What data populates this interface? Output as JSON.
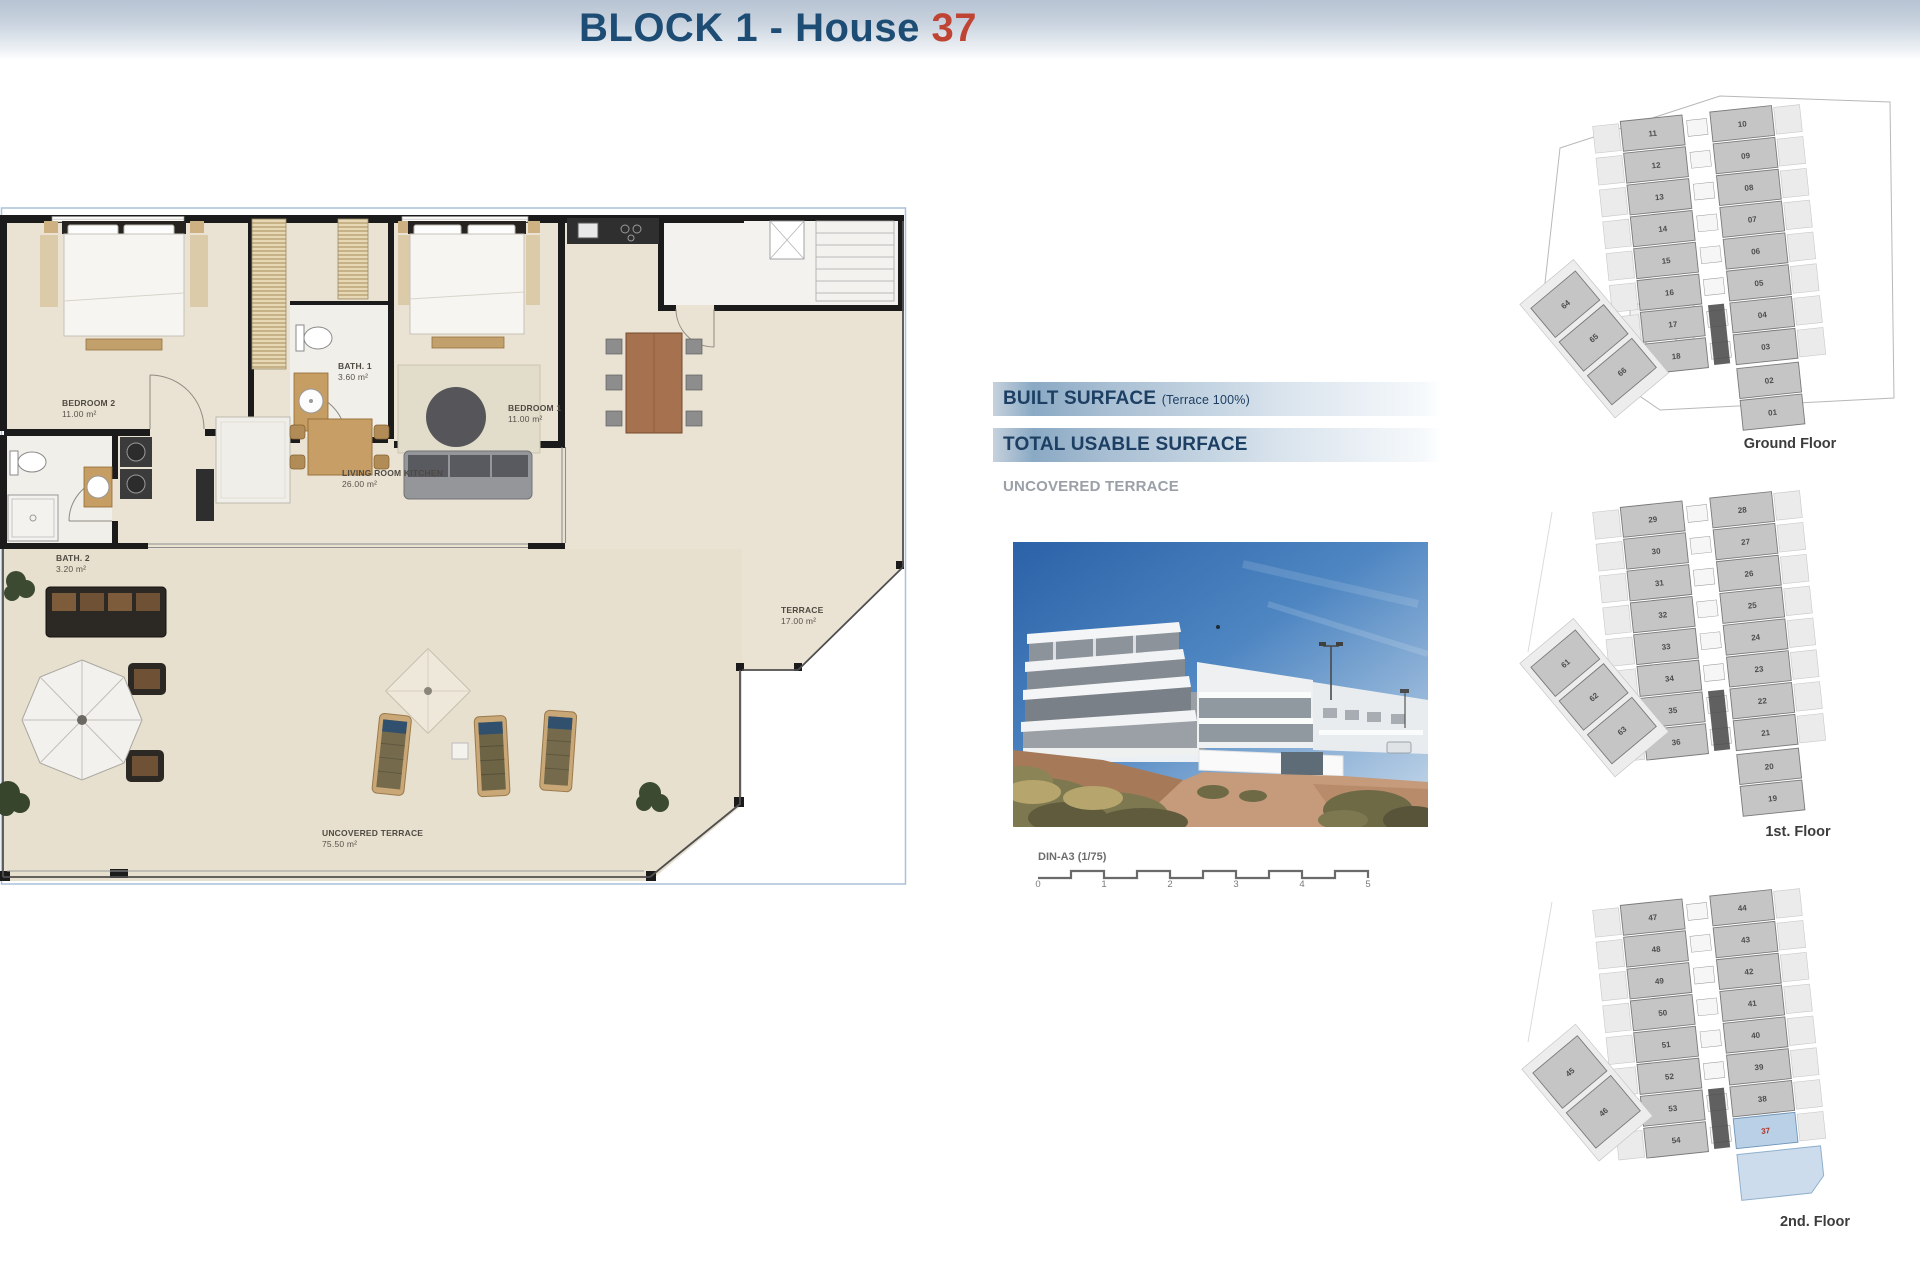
{
  "header": {
    "title_prefix": "BLOCK 1 - House ",
    "house_number": "37"
  },
  "plan": {
    "rooms": {
      "bedroom2": {
        "name": "BEDROOM 2",
        "area": "11.00 m²"
      },
      "bath1": {
        "name": "BATH. 1",
        "area": "3.60 m²"
      },
      "bedroom1": {
        "name": "BEDROOM 1",
        "area": "11.00 m²"
      },
      "living": {
        "name": "LIVING ROOM KITCHEN",
        "area": "26.00 m²"
      },
      "bath2": {
        "name": "BATH. 2",
        "area": "3.20 m²"
      },
      "terrace": {
        "name": "TERRACE",
        "area": "17.00 m²"
      },
      "uncovered": {
        "name": "UNCOVERED TERRACE",
        "area": "75.50 m²"
      }
    }
  },
  "surface_table": {
    "rows": [
      {
        "label": "BUILT SURFACE",
        "note": "(Terrace 100%)",
        "value": "78.80 m²"
      },
      {
        "label": "TOTAL USABLE SURFACE",
        "note": "",
        "value": "72.00 m²"
      },
      {
        "label": "UNCOVERED TERRACE",
        "note": "",
        "value": "75.70 m²"
      }
    ]
  },
  "scale_bar": {
    "label": "DIN-A3 (1/75)",
    "ticks": [
      "0",
      "1",
      "2",
      "3",
      "4",
      "5"
    ]
  },
  "floors": [
    {
      "id": "ground",
      "label": "Ground Floor",
      "left_col": [
        "11",
        "12",
        "13",
        "14",
        "15",
        "16",
        "17",
        "18"
      ],
      "right_col": [
        "10",
        "09",
        "08",
        "07",
        "06",
        "05",
        "04",
        "03"
      ],
      "bottom_extra": [
        "02",
        "01"
      ],
      "diag": [
        "64",
        "65",
        "66"
      ],
      "highlight": null
    },
    {
      "id": "first",
      "label": "1st. Floor",
      "left_col": [
        "29",
        "30",
        "31",
        "32",
        "33",
        "34",
        "35",
        "36"
      ],
      "right_col": [
        "28",
        "27",
        "26",
        "25",
        "24",
        "23",
        "22",
        "21"
      ],
      "bottom_extra": [
        "20",
        "19"
      ],
      "diag": [
        "61",
        "62",
        "63"
      ],
      "highlight": null
    },
    {
      "id": "second",
      "label": "2nd. Floor",
      "left_col": [
        "47",
        "48",
        "49",
        "50",
        "51",
        "52",
        "53",
        "54"
      ],
      "right_col": [
        "44",
        "43",
        "42",
        "41",
        "40",
        "39",
        "38",
        "37"
      ],
      "bottom_extra": [],
      "diag": [
        "45",
        "46"
      ],
      "highlight": "37"
    }
  ],
  "colors": {
    "accent_blue": "#1d4c74",
    "accent_red": "#bf4434",
    "table_bar_blue": "#8aa9c4",
    "highlight_unit_fill": "#b9d0e6",
    "highlight_unit_number": "#b13227"
  }
}
